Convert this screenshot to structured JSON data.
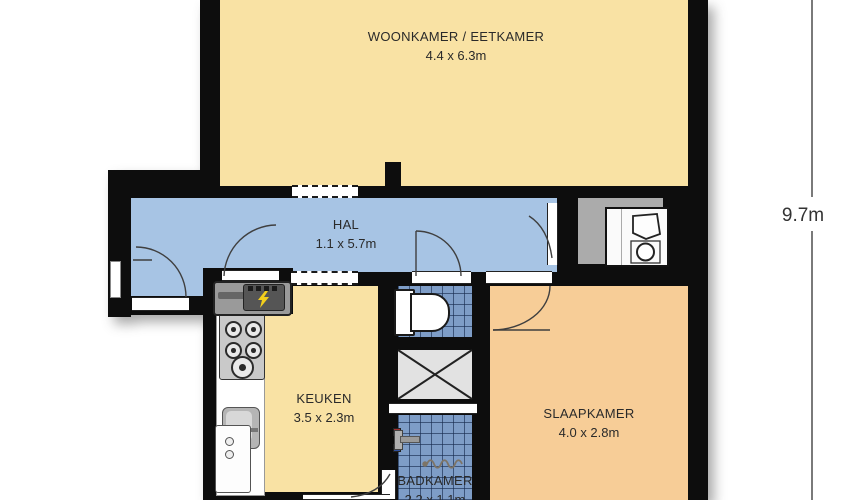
{
  "floorplan": {
    "rooms": {
      "living": {
        "name": "WOONKAMER / EETKAMER",
        "dims": "4.4 x 6.3m"
      },
      "hall": {
        "name": "HAL",
        "dims": "1.1 x 5.7m"
      },
      "kitchen": {
        "name": "KEUKEN",
        "dims": "3.5 x 2.3m"
      },
      "bedroom": {
        "name": "SLAAPKAMER",
        "dims": "4.0 x 2.8m"
      },
      "bathroom": {
        "name": "BADKAMER",
        "dims": "2.2 x 1.1m"
      }
    },
    "dimension_label": "9.7m",
    "icons": {
      "toilet": "toilet-icon",
      "washing_machine": "washing-machine-icon",
      "stove": "stove-burners-icon",
      "sink": "kitchen-sink-icon",
      "electrical_meter": "lightning-bolt-icon",
      "shower_mixer": "shower-mixer-icon",
      "drain_pipe": "drain-pipe-icon",
      "shaft": "shaft-cross-icon",
      "doors": "door-arc-icon",
      "passages": "dashed-opening-icon"
    },
    "colors": {
      "c-wall": "#0d0d0d",
      "c-living": "#f9e2a4",
      "c-hall": "#a7c4e4",
      "c-kitchen": "#f9e2a4",
      "c-bedroom": "#f7cd97",
      "c-utility": "#ababab",
      "c-tile": "#7e9dc7",
      "c-shaft": "#e2e2e2",
      "c-text": "#2a2a2a"
    }
  }
}
